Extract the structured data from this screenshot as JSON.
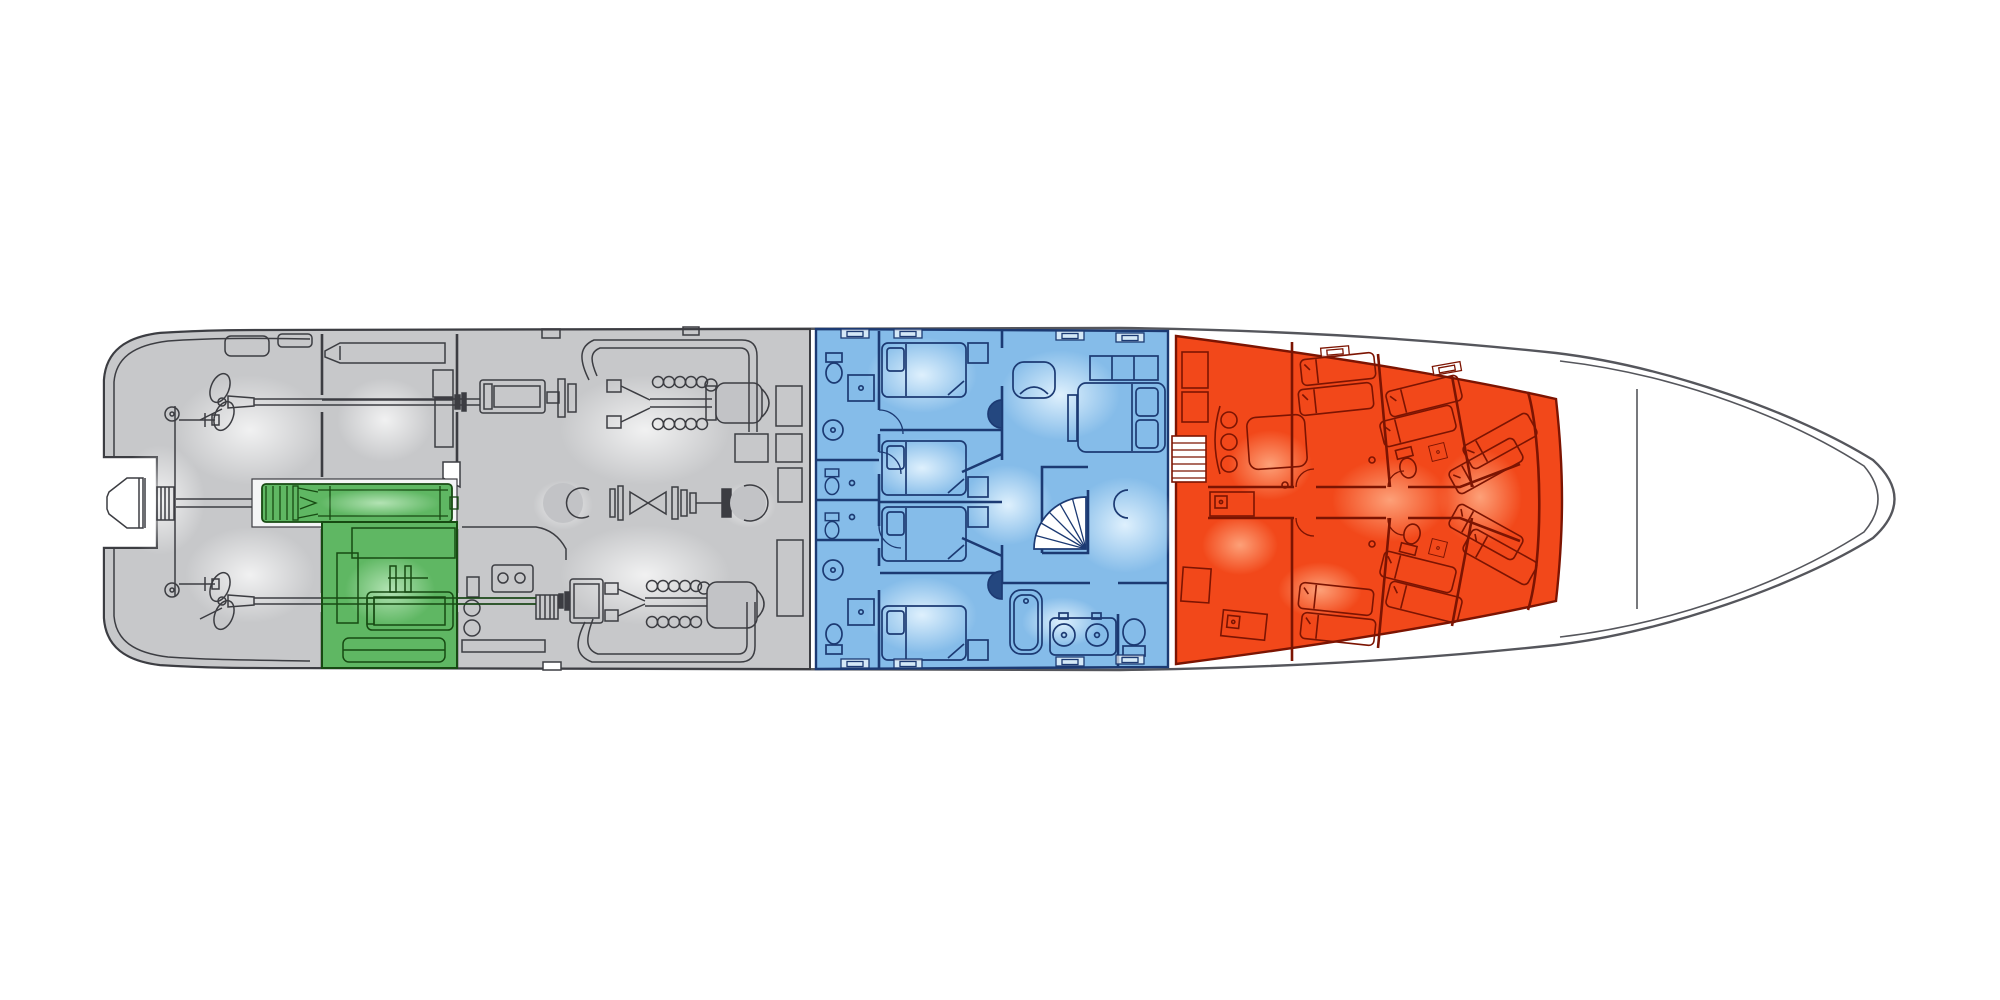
{
  "canvas": {
    "width": 2000,
    "height": 1000,
    "background_color": "#ffffff"
  },
  "drawing": {
    "type": "yacht-deck-plan",
    "view": "top-down lower-deck floor plan, stern at left, bow at right",
    "visible_text": ""
  },
  "palette": {
    "hull_fill": "#ffffff",
    "hull_line": "#55565c",
    "gray_fill": "#c7c8ca",
    "gray_line": "#3c3d42",
    "gray_machine_fill": "#c2c3c6",
    "green_fill": "#5fb763",
    "green_line": "#174a12",
    "blue_fill": "#85bce9",
    "blue_line": "#1c3a73",
    "blue_door_fill": "#24477f",
    "red_fill": "#f2481a",
    "red_line": "#7c1402",
    "white_detail": "#ffffff"
  },
  "zones": {
    "aft_machinery": {
      "name": "aft-machinery-and-steering",
      "color": "#c7c8ca"
    },
    "green_compartment": {
      "name": "highlighted-center-drive-compartment",
      "color": "#5fb763"
    },
    "engine_room": {
      "name": "engine-room",
      "color": "#c7c8ca"
    },
    "guest_cabins": {
      "name": "guest-cabin-section",
      "color": "#85bce9"
    },
    "crew_quarters": {
      "name": "crew-quarters-section",
      "color": "#f2481a"
    },
    "bow": {
      "name": "bow-forepeak",
      "color": "#ffffff"
    }
  },
  "features": {
    "propellers": 2,
    "rudders": 2,
    "main_engines": 2,
    "centerline_drive_trains": 1,
    "guest_cabins": 4,
    "guest_wet_rooms": 4,
    "vip_cabin_beds": 1,
    "spiral_staircase": 1,
    "bathtub": 1,
    "double_sink_vanity": 1,
    "crew_bunks": 12,
    "crew_companionway_stairs": 1,
    "hull_window_marks": 12
  }
}
